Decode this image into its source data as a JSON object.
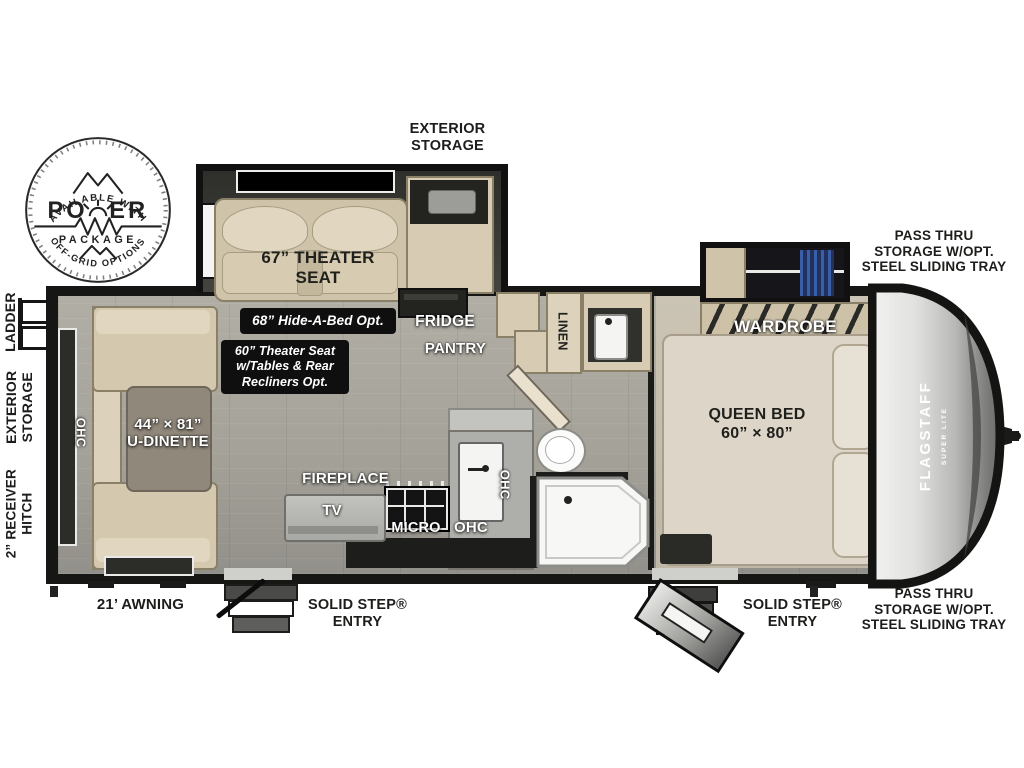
{
  "power_badge": {
    "top_arc": "AVAILABLE WITH",
    "name_left": "PO",
    "name_right": "ER",
    "package": "PACKAGE",
    "bottom_arc": "OFF-GRID OPTIONS"
  },
  "exterior": {
    "exterior_storage_top": "EXTERIOR\nSTORAGE",
    "pass_thru": "PASS THRU\nSTORAGE W/OPT.\nSTEEL SLIDING TRAY",
    "ladder": "LADDER",
    "exterior_storage_side": "EXTERIOR\nSTORAGE",
    "receiver_hitch": "2” RECEIVER\nHITCH",
    "awning": "21’ AWNING",
    "solid_step": "SOLID STEP®\nENTRY"
  },
  "living_area": {
    "theater_seat": "67” THEATER\nSEAT",
    "hide_a_bed_option": "68” Hide-A-Bed Opt.",
    "theater_seat_option": "60” Theater Seat\nw/Tables & Rear\nRecliners Opt.",
    "dinette": "44” × 81”\nU-DINETTE",
    "dinette_ohc": "OHC"
  },
  "kitchen": {
    "fridge": "FRIDGE",
    "pantry": "PANTRY",
    "fireplace": "FIREPLACE",
    "tv": "TV",
    "micro": "MICRO",
    "ohc": "OHC",
    "ohc_sink": "OHC"
  },
  "bath": {
    "linen": "LINEN"
  },
  "bedroom": {
    "wardrobe": "WARDROBE",
    "tv_option": "TV Opt.",
    "queen_bed": "QUEEN BED\n60” × 80”",
    "ohc": "OHC"
  },
  "brand": {
    "name": "FLAGSTAFF",
    "sub": "SUPER LITE"
  },
  "colors": {
    "clothes_blue": "#3b5ea8",
    "floor_gray": "#a9a69d",
    "cabinet_beige": "#d7ccb3",
    "wall_black": "#161614"
  }
}
